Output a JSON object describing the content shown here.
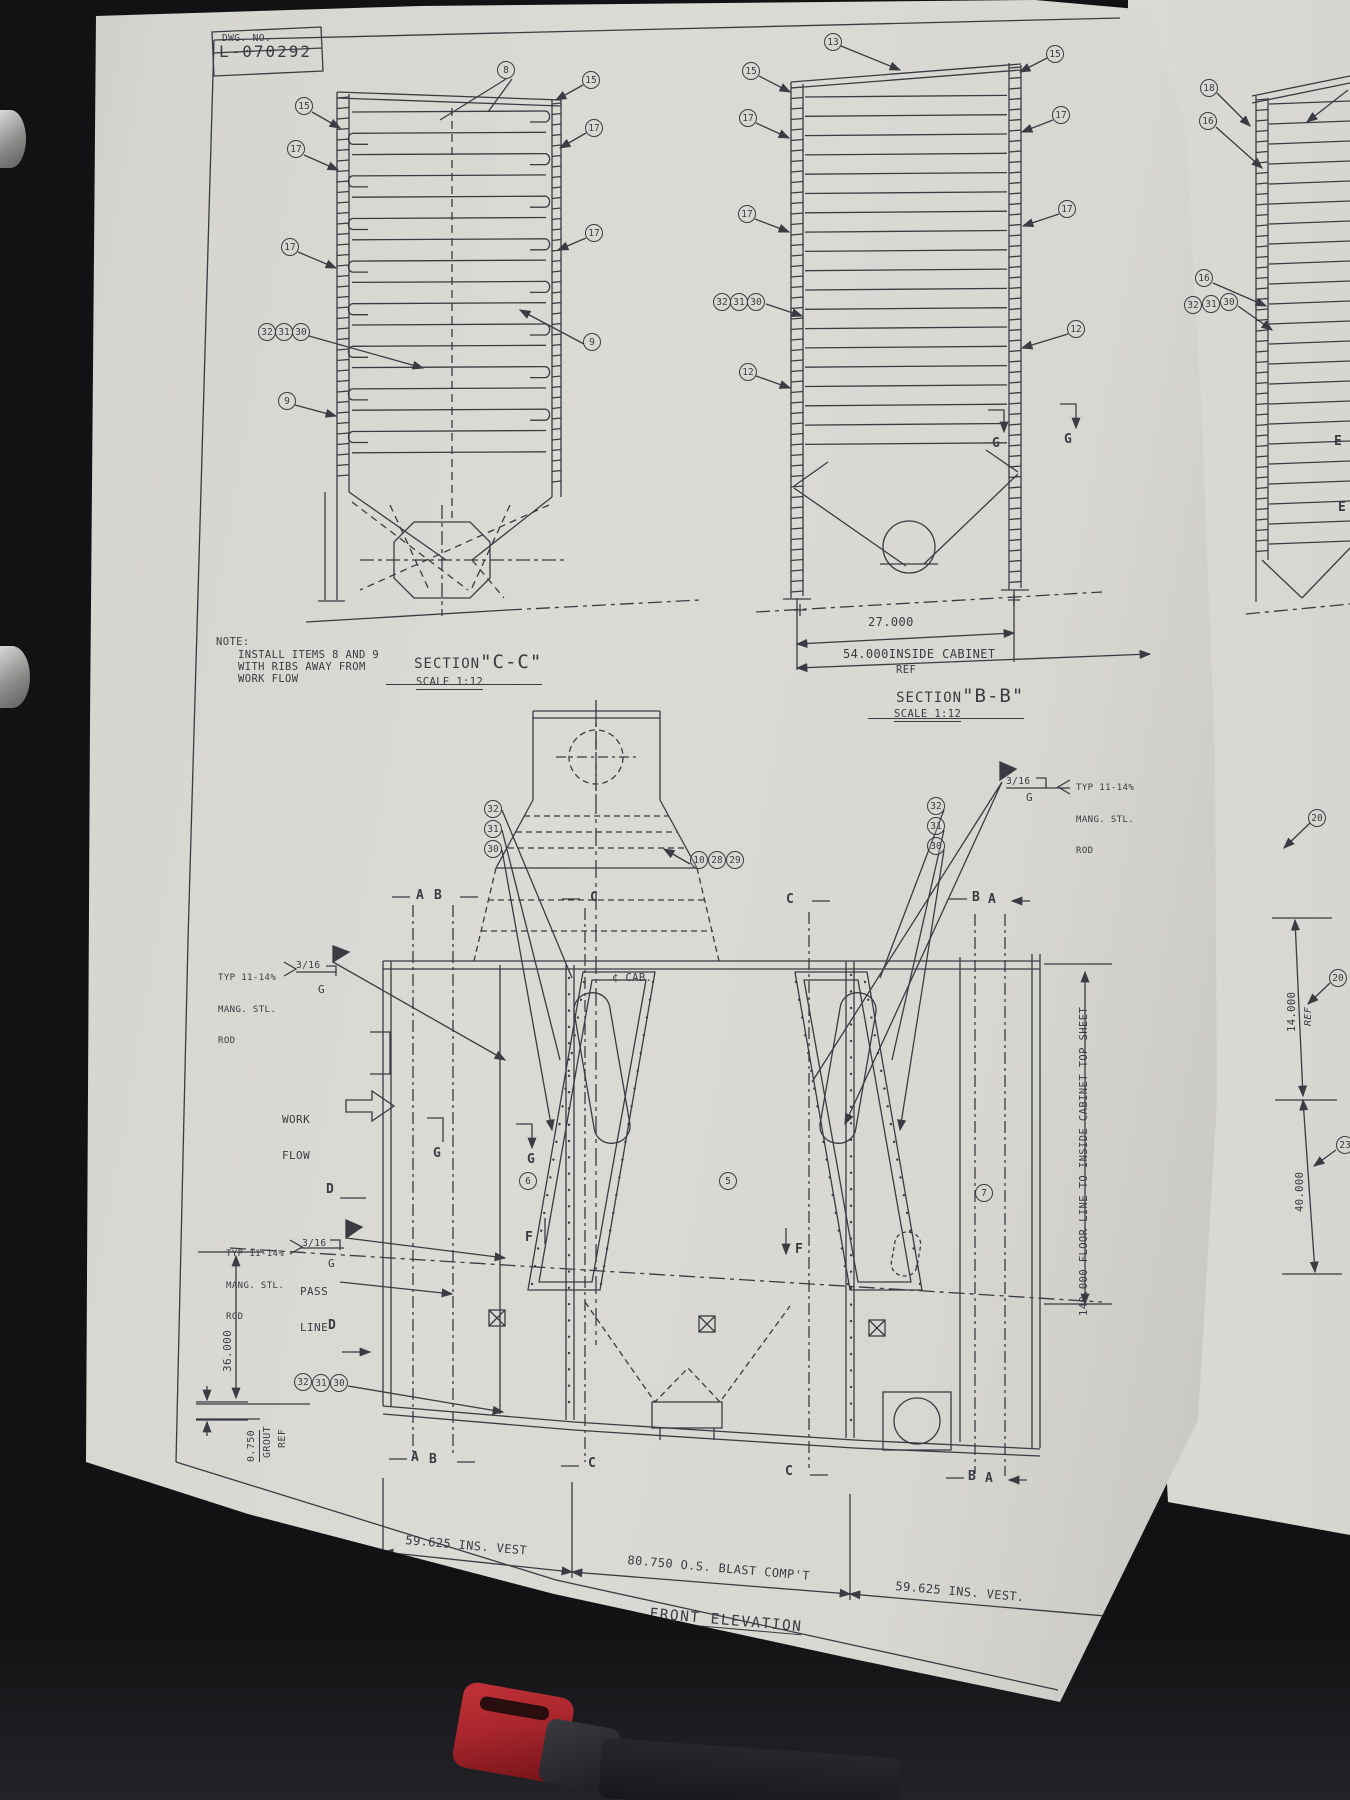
{
  "ink": "#3b3b43",
  "paper": "#d8d7d2",
  "sheet": {
    "dwg_label": "DWG. NO.",
    "dwg_no": "L-070292"
  },
  "sections": {
    "cc": {
      "title": "SECTION",
      "name": "\"C-C\"",
      "scale": "SCALE 1:12",
      "note": {
        "head": "NOTE:",
        "l1": "INSTALL ITEMS 8 AND 9",
        "l2": "WITH RIBS AWAY FROM",
        "l3": "WORK FLOW"
      }
    },
    "bb": {
      "title": "SECTION",
      "name": "\"B-B\"",
      "scale": "SCALE 1:12",
      "dim_half": "27.000",
      "dim_full": "54.000INSIDE CABINET",
      "dim_ref": "REF"
    }
  },
  "front": {
    "title": "FRONT ELEVATION",
    "dim_left_vest": "59.625 INS. VEST",
    "dim_blast": "80.750 O.S. BLAST COMP'T",
    "dim_right_vest": "59.625 INS. VEST.",
    "dim_height": "140.000 FLOOR LINE TO INSIDE CABINET TOP SHEET",
    "dim_36": "36.000",
    "dim_grout": "0.750",
    "grout_l1": "GROUT",
    "grout_l2": "REF",
    "pass_l1": "PASS",
    "pass_l2": "LINE",
    "work_l1": "WORK",
    "work_l2": "FLOW",
    "cab_center": "¢ CAB."
  },
  "weld_note": {
    "l1": "TYP 11-14%",
    "l2": "MANG. STL.",
    "l3": "ROD",
    "size": "3/16",
    "process": "G"
  },
  "right_page": {
    "dim_14": "14.000",
    "dim_14_ref": "REF",
    "dim_40": "40.000"
  },
  "callouts": [
    {
      "n": "8",
      "x": 506,
      "y": 70
    },
    {
      "n": "15",
      "x": 304,
      "y": 106
    },
    {
      "n": "17",
      "x": 296,
      "y": 149
    },
    {
      "n": "17",
      "x": 290,
      "y": 247
    },
    {
      "n": "32",
      "x": 267,
      "y": 332
    },
    {
      "n": "31",
      "x": 284,
      "y": 332
    },
    {
      "n": "30",
      "x": 301,
      "y": 332
    },
    {
      "n": "9",
      "x": 287,
      "y": 401
    },
    {
      "n": "15",
      "x": 591,
      "y": 80
    },
    {
      "n": "17",
      "x": 594,
      "y": 128
    },
    {
      "n": "17",
      "x": 594,
      "y": 233
    },
    {
      "n": "9",
      "x": 592,
      "y": 342
    },
    {
      "n": "13",
      "x": 833,
      "y": 42
    },
    {
      "n": "15",
      "x": 751,
      "y": 71
    },
    {
      "n": "15",
      "x": 1055,
      "y": 54
    },
    {
      "n": "17",
      "x": 748,
      "y": 118
    },
    {
      "n": "17",
      "x": 1061,
      "y": 115
    },
    {
      "n": "17",
      "x": 747,
      "y": 214
    },
    {
      "n": "17",
      "x": 1067,
      "y": 209
    },
    {
      "n": "32",
      "x": 722,
      "y": 302
    },
    {
      "n": "31",
      "x": 739,
      "y": 302
    },
    {
      "n": "30",
      "x": 756,
      "y": 302
    },
    {
      "n": "12",
      "x": 748,
      "y": 372
    },
    {
      "n": "12",
      "x": 1076,
      "y": 329
    },
    {
      "n": "18",
      "x": 1209,
      "y": 88
    },
    {
      "n": "16",
      "x": 1208,
      "y": 121
    },
    {
      "n": "16",
      "x": 1204,
      "y": 278
    },
    {
      "n": "32",
      "x": 1193,
      "y": 305
    },
    {
      "n": "31",
      "x": 1211,
      "y": 304
    },
    {
      "n": "30",
      "x": 1229,
      "y": 302
    },
    {
      "n": "20",
      "x": 1317,
      "y": 818
    },
    {
      "n": "20",
      "x": 1338,
      "y": 978
    },
    {
      "n": "23",
      "x": 1345,
      "y": 1145
    },
    {
      "n": "10",
      "x": 699,
      "y": 860
    },
    {
      "n": "28",
      "x": 717,
      "y": 860
    },
    {
      "n": "29",
      "x": 735,
      "y": 860
    },
    {
      "n": "32",
      "x": 493,
      "y": 809
    },
    {
      "n": "31",
      "x": 493,
      "y": 829
    },
    {
      "n": "30",
      "x": 493,
      "y": 849
    },
    {
      "n": "32",
      "x": 936,
      "y": 806
    },
    {
      "n": "31",
      "x": 936,
      "y": 826
    },
    {
      "n": "30",
      "x": 936,
      "y": 846
    },
    {
      "n": "6",
      "x": 528,
      "y": 1181
    },
    {
      "n": "5",
      "x": 728,
      "y": 1181
    },
    {
      "n": "7",
      "x": 984,
      "y": 1193
    },
    {
      "n": "32",
      "x": 303,
      "y": 1382
    },
    {
      "n": "31",
      "x": 321,
      "y": 1383
    },
    {
      "n": "30",
      "x": 339,
      "y": 1383
    }
  ],
  "markers": [
    {
      "t": "A",
      "x": 416,
      "y": 888
    },
    {
      "t": "B",
      "x": 434,
      "y": 888
    },
    {
      "t": "C",
      "x": 590,
      "y": 890
    },
    {
      "t": "C",
      "x": 786,
      "y": 892
    },
    {
      "t": "B",
      "x": 972,
      "y": 890
    },
    {
      "t": "A",
      "x": 988,
      "y": 892
    },
    {
      "t": "A",
      "x": 411,
      "y": 1450
    },
    {
      "t": "B",
      "x": 429,
      "y": 1452
    },
    {
      "t": "C",
      "x": 588,
      "y": 1456
    },
    {
      "t": "C",
      "x": 785,
      "y": 1464
    },
    {
      "t": "B",
      "x": 968,
      "y": 1469
    },
    {
      "t": "A",
      "x": 985,
      "y": 1471
    },
    {
      "t": "D",
      "x": 326,
      "y": 1182
    },
    {
      "t": "D",
      "x": 328,
      "y": 1318
    },
    {
      "t": "F",
      "x": 525,
      "y": 1230
    },
    {
      "t": "F",
      "x": 795,
      "y": 1242
    },
    {
      "t": "G",
      "x": 433,
      "y": 1146
    },
    {
      "t": "G",
      "x": 527,
      "y": 1152
    },
    {
      "t": "G",
      "x": 992,
      "y": 436
    },
    {
      "t": "G",
      "x": 1064,
      "y": 432
    },
    {
      "t": "E",
      "x": 1334,
      "y": 434
    },
    {
      "t": "E",
      "x": 1338,
      "y": 500
    }
  ]
}
